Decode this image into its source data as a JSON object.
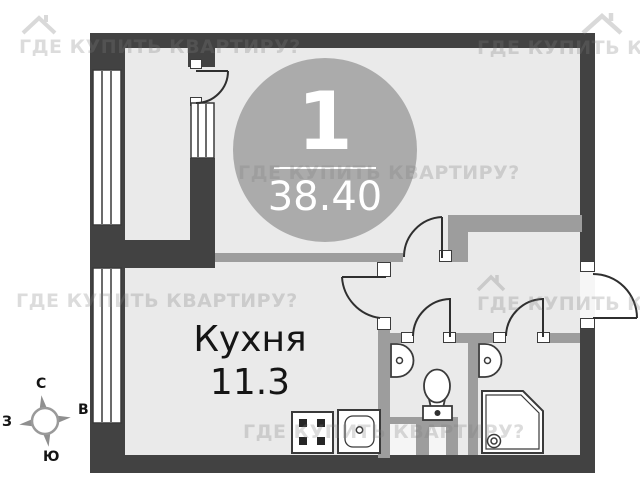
{
  "badge": {
    "number": "1",
    "area": "38.40"
  },
  "rooms": [
    {
      "name": "Кухня",
      "area": "11.3"
    }
  ],
  "compass": {
    "north": "С",
    "east": "В",
    "south": "Ю",
    "west": "З"
  },
  "watermark": {
    "text": "ГДЕ КУПИТЬ КВАРТИРУ?",
    "logo": "house-icon"
  },
  "colors": {
    "wall_exterior": "#424242",
    "wall_interior": "#9d9d9d",
    "floor": "#eaeaea",
    "badge_background": "#ababab",
    "badge_text": "#ffffff",
    "label_text": "#151515",
    "watermark": "#e0e0e0"
  }
}
